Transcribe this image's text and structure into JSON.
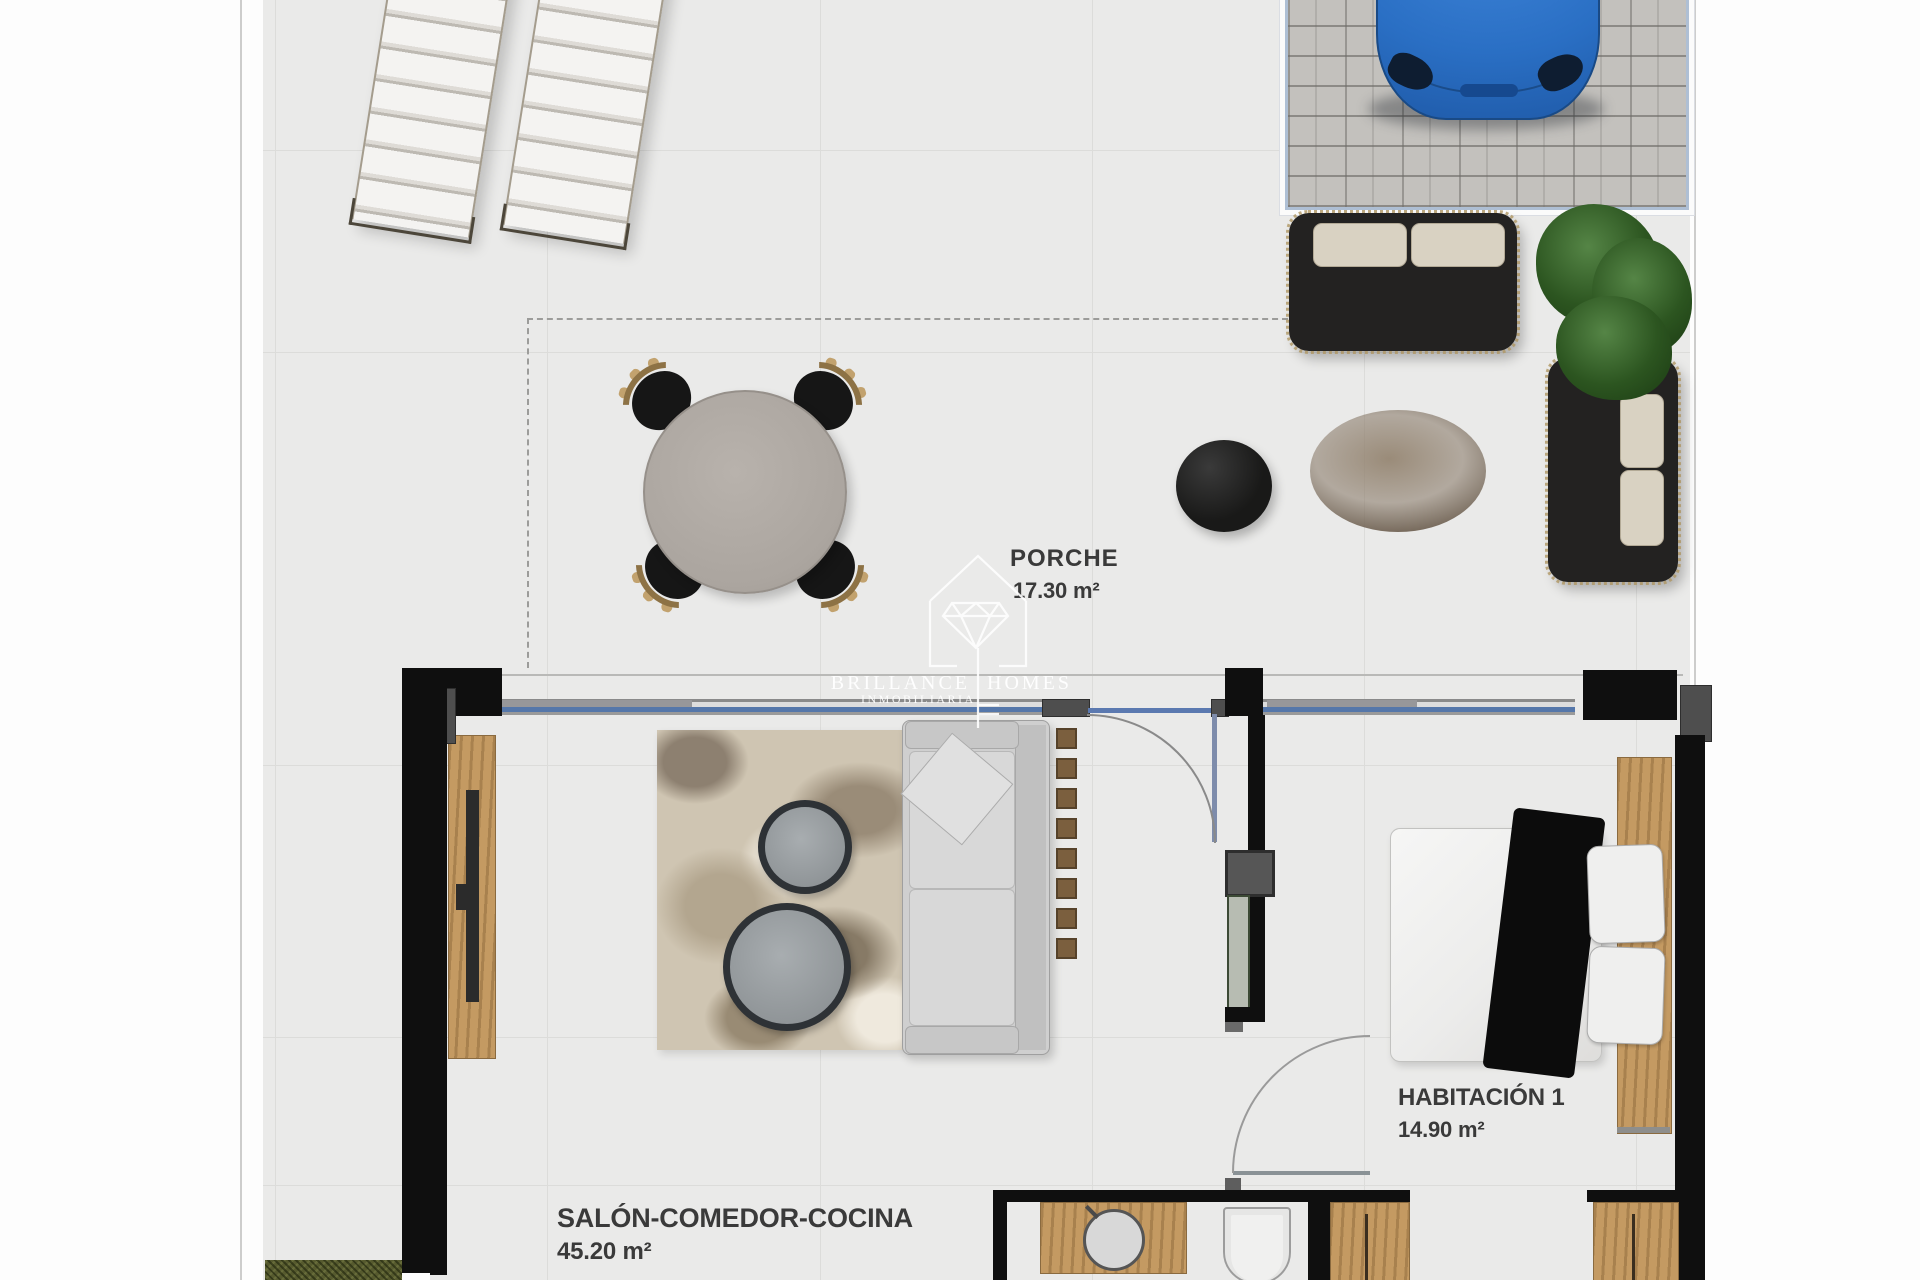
{
  "rooms": {
    "porch": {
      "label": "PORCHE",
      "area": "17.30 m²"
    },
    "living": {
      "label": "SALÓN-COMEDOR-COCINA",
      "area": "45.20 m²"
    },
    "bedroom": {
      "label": "HABITACIÓN 1",
      "area": "14.90 m²"
    }
  },
  "watermark": {
    "brand_word1": "BRILLANCE",
    "brand_word2": "HOMES",
    "subtitle": "INMOBILIARIA"
  },
  "colors": {
    "car_blue": "#2a6fc4",
    "window_blue": "#5577aa",
    "wall_black": "#0f0f0f",
    "wood_tan": "#c49a62",
    "floor_gray": "#eaeae9",
    "grass_green": "#565a2e",
    "plant_green": "#2c5520",
    "cushion_beige": "#d9d2c2"
  }
}
